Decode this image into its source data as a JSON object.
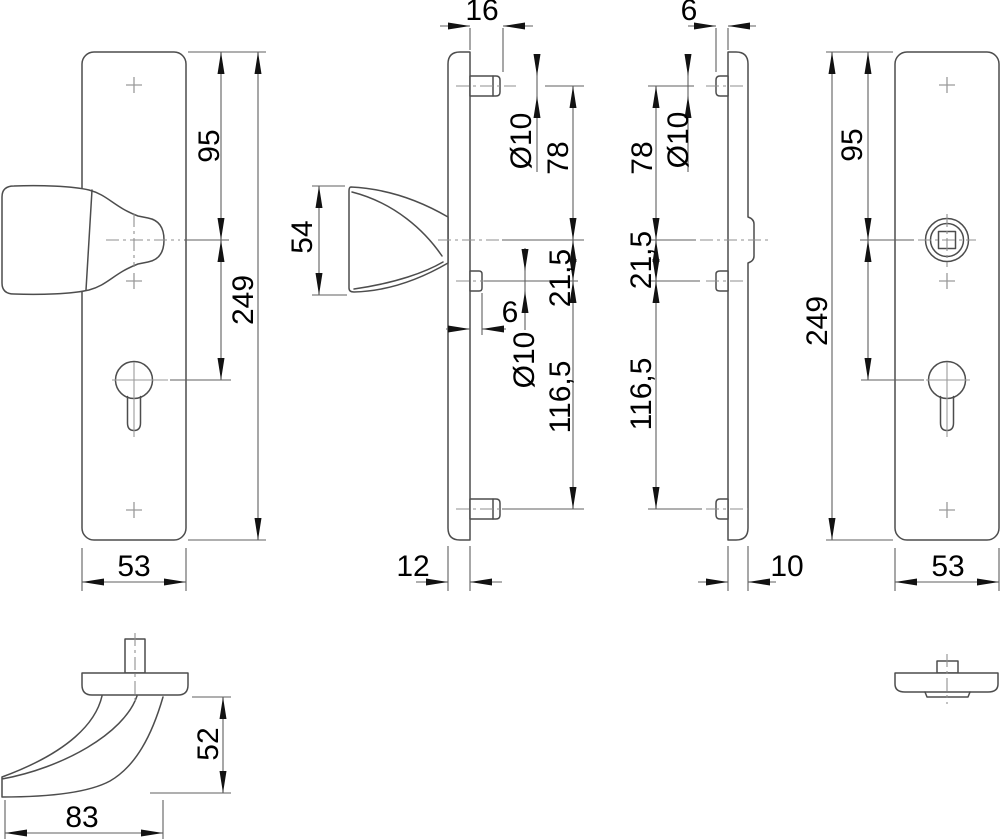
{
  "drawing": {
    "type": "technical-dimension-drawing",
    "subject": "security-door-fitting-knob-plate-and-inner-plate",
    "units_style": "decimal-comma"
  },
  "colors": {
    "background": "#ffffff",
    "object_line": "#4d4d4d",
    "dimension_line": "#5f5f5f",
    "centerline": "#8f8f8f",
    "text": "#000000"
  },
  "dimensions": {
    "front_outer": {
      "top_to_knob": "95",
      "total_height": "249",
      "width": "53"
    },
    "side_outer": {
      "screw_boss_length": "16",
      "knob_projection": "54",
      "screw_hole_dia": "Ø10",
      "top_screw_to_center": "78",
      "center_to_cylinder": "21,5",
      "cylinder_boss_length": "6",
      "cylinder_hole_dia": "Ø10",
      "cylinder_to_bottom": "116,5",
      "plate_thickness": "12"
    },
    "side_inner": {
      "screw_boss_length": "6",
      "screw_hole_dia": "Ø10",
      "top_screw_to_center": "78",
      "center_to_cylinder": "21,5",
      "cylinder_to_bottom": "116,5",
      "plate_thickness": "10"
    },
    "front_inner": {
      "top_to_spindle": "95",
      "total_height": "249",
      "width": "53"
    },
    "top_knob": {
      "knob_length": "83",
      "knob_projection": "52"
    }
  }
}
